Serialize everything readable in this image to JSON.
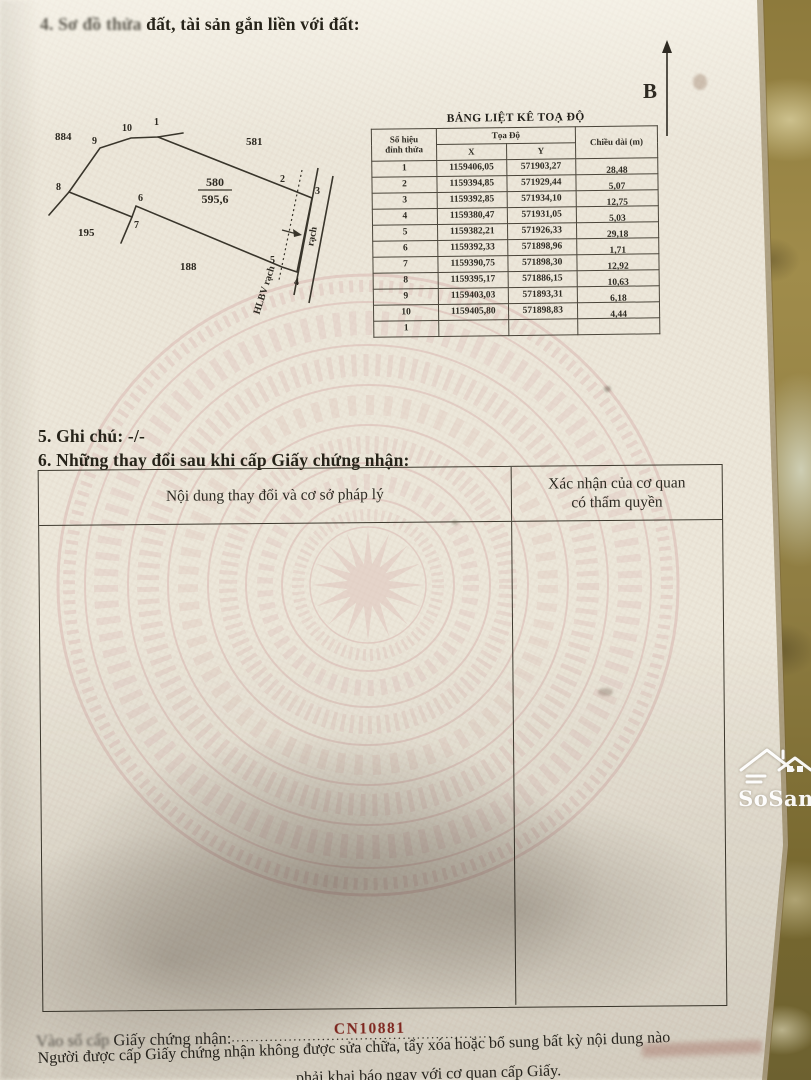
{
  "colors": {
    "paper": "#ece7da",
    "pattern_pink": "#d9b5b0",
    "line_ink": "#39352b",
    "issue_red": "#8c2a22",
    "granite": "#8f7d42"
  },
  "header": {
    "section4_blurred": "4. Sơ đồ thửa",
    "section4_text": " đất, tài sản gắn liền với đất:"
  },
  "north": {
    "label": "B"
  },
  "diagram": {
    "plot_number": "580",
    "area": "595,6",
    "neighbor_top_left": "884",
    "neighbor_top_right": "581",
    "neighbor_left": "195",
    "neighbor_bottom": "188",
    "vertices": [
      "1",
      "2",
      "3",
      "4",
      "5",
      "6",
      "7",
      "8",
      "9",
      "10"
    ],
    "corridor_label": "HLBV rạch",
    "canal_label": "rạch"
  },
  "coord_table": {
    "title": "BẢNG LIỆT KÊ TOẠ ĐỘ",
    "headers": {
      "vertex_line1": "Số hiệu",
      "vertex_line2": "đỉnh thửa",
      "coords": "Tọa Độ",
      "x": "X",
      "y": "Y",
      "length": "Chiều dài (m)"
    },
    "rows": [
      {
        "v": "1",
        "x": "1159406,05",
        "y": "571903,27",
        "len": "28,48"
      },
      {
        "v": "2",
        "x": "1159394,85",
        "y": "571929,44",
        "len": "5,07"
      },
      {
        "v": "3",
        "x": "1159392,85",
        "y": "571934,10",
        "len": "12,75"
      },
      {
        "v": "4",
        "x": "1159380,47",
        "y": "571931,05",
        "len": "5,03"
      },
      {
        "v": "5",
        "x": "1159382,21",
        "y": "571926,33",
        "len": "29,18"
      },
      {
        "v": "6",
        "x": "1159392,33",
        "y": "571898,96",
        "len": "1,71"
      },
      {
        "v": "7",
        "x": "1159390,75",
        "y": "571898,30",
        "len": "12,92"
      },
      {
        "v": "8",
        "x": "1159395,17",
        "y": "571886,15",
        "len": "10,63"
      },
      {
        "v": "9",
        "x": "1159403,03",
        "y": "571893,31",
        "len": "6,18"
      },
      {
        "v": "10",
        "x": "1159405,80",
        "y": "571898,83",
        "len": "4,44"
      },
      {
        "v": "1",
        "x": "",
        "y": "",
        "len": ""
      }
    ]
  },
  "section5": {
    "text": "5. Ghi chú: -/-"
  },
  "section6": {
    "title": "6. Những thay đổi sau khi cấp Giấy chứng nhận:",
    "col_content": "Nội dung thay đổi và cơ sở pháp lý",
    "col_confirm_line1": "Xác nhận của cơ quan",
    "col_confirm_line2": "có thẩm quyền"
  },
  "issue": {
    "label_blurred": "Vào sổ cấp",
    "label": " Giấy chứng nhận:",
    "dots": ".......................................................",
    "number": "CN10881"
  },
  "footer": {
    "line1": "Người được cấp Giấy chứng nhận không được sửa chữa, tẩy xóa hoặc bổ sung bất kỳ nội dung nào",
    "line2": "phải khai báo ngay với cơ quan cấp Giấy."
  },
  "watermark": {
    "name": "SoSan"
  }
}
